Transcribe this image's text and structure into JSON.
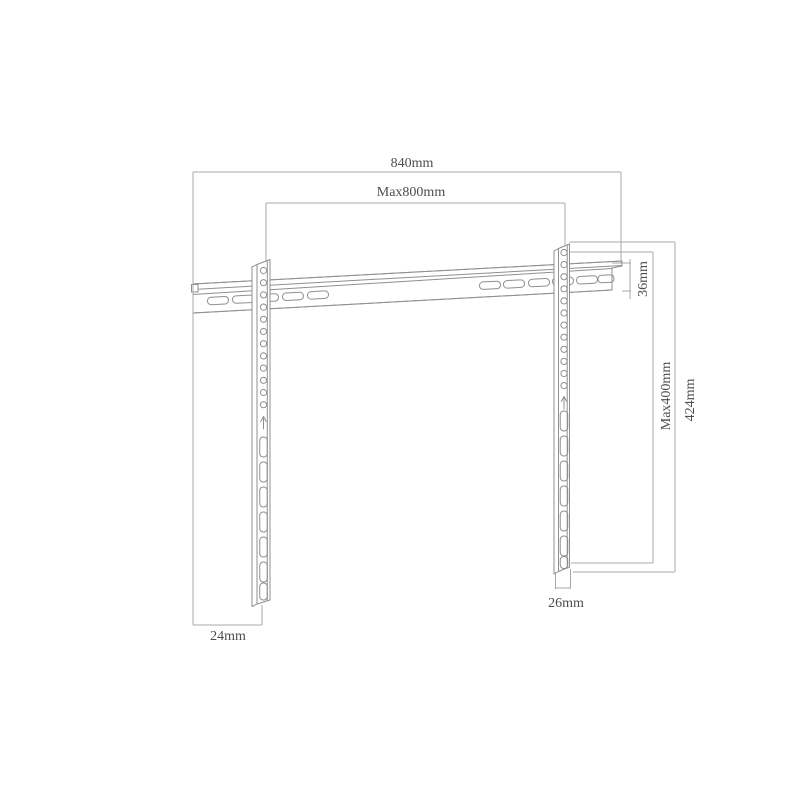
{
  "diagram": {
    "type": "technical-drawing",
    "subject": "Fixed TV wall mount bracket dimension diagram",
    "labels": {
      "overall_width": "840mm",
      "max_mount_width": "Max800mm",
      "rail_profile_height": "36mm",
      "max_mount_height": "Max400mm",
      "bracket_total_height": "424mm",
      "right_bracket_width": "26mm",
      "left_bracket_width": "24mm"
    },
    "colors": {
      "background": "#ffffff",
      "part_outline": "#8f8f8f",
      "dimension_line": "#a8a8a8",
      "label_text": "#4d4d4d"
    }
  }
}
